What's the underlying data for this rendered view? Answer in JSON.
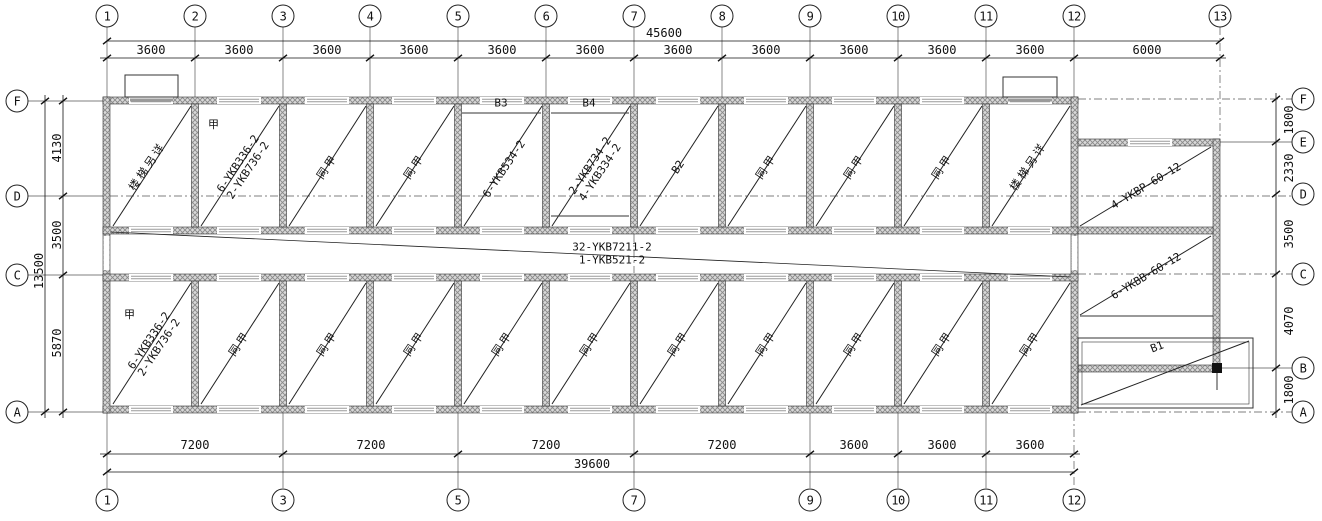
{
  "plan": {
    "grid": {
      "top": [
        "1",
        "2",
        "3",
        "4",
        "5",
        "6",
        "7",
        "8",
        "9",
        "10",
        "11",
        "12",
        "13"
      ],
      "bottom": [
        "1",
        "3",
        "5",
        "7",
        "9",
        "10",
        "11",
        "12"
      ],
      "left": [
        "F",
        "D",
        "C",
        "A"
      ],
      "right": [
        "F",
        "E",
        "D",
        "C",
        "B",
        "A"
      ]
    },
    "dims": {
      "top_total": "45600",
      "top": [
        "3600",
        "3600",
        "3600",
        "3600",
        "3600",
        "3600",
        "3600",
        "3600",
        "3600",
        "3600",
        "3600",
        "6000"
      ],
      "bottom": [
        "7200",
        "7200",
        "7200",
        "7200",
        "3600",
        "3600",
        "3600"
      ],
      "bottom_total": "39600",
      "left": [
        "4130",
        "3500",
        "5870"
      ],
      "left_total": "13500",
      "right": [
        "1800",
        "2330",
        "3500",
        "4070",
        "1800"
      ]
    },
    "rooms_top": [
      {
        "label": "楼梯另详"
      },
      {
        "mark": "甲",
        "line1": "6-YKB336-2",
        "line2": "2-YKB736-2"
      },
      {
        "label": "同甲"
      },
      {
        "label": "同甲"
      },
      {
        "beam": "B3",
        "line1": "6-YKB534-2"
      },
      {
        "beam": "B4",
        "line1": "2-YKB734-2",
        "line2": "4-YKB334-2"
      },
      {
        "beam": "B2"
      },
      {
        "label": "同甲"
      },
      {
        "label": "同甲"
      },
      {
        "label": "同甲"
      },
      {
        "label": "楼梯另详"
      }
    ],
    "rooms_bottom": [
      {
        "mark": "甲",
        "line1": "6-YKB336-2",
        "line2": "2-YKB736-2"
      },
      {
        "label": "同甲"
      },
      {
        "label": "同甲"
      },
      {
        "label": "同甲"
      },
      {
        "label": "同甲"
      },
      {
        "label": "同甲"
      },
      {
        "label": "同甲"
      },
      {
        "label": "同甲"
      },
      {
        "label": "同甲"
      },
      {
        "label": "同甲"
      },
      {
        "label": "同甲"
      }
    ],
    "corridor": {
      "line1": "32-YKB7211-2",
      "line2": "1-YKB521-2"
    },
    "annex": {
      "upper": "4-YKBP-60-12",
      "lower": "6-YKBB-60-12",
      "porch_beam": "B1"
    }
  }
}
